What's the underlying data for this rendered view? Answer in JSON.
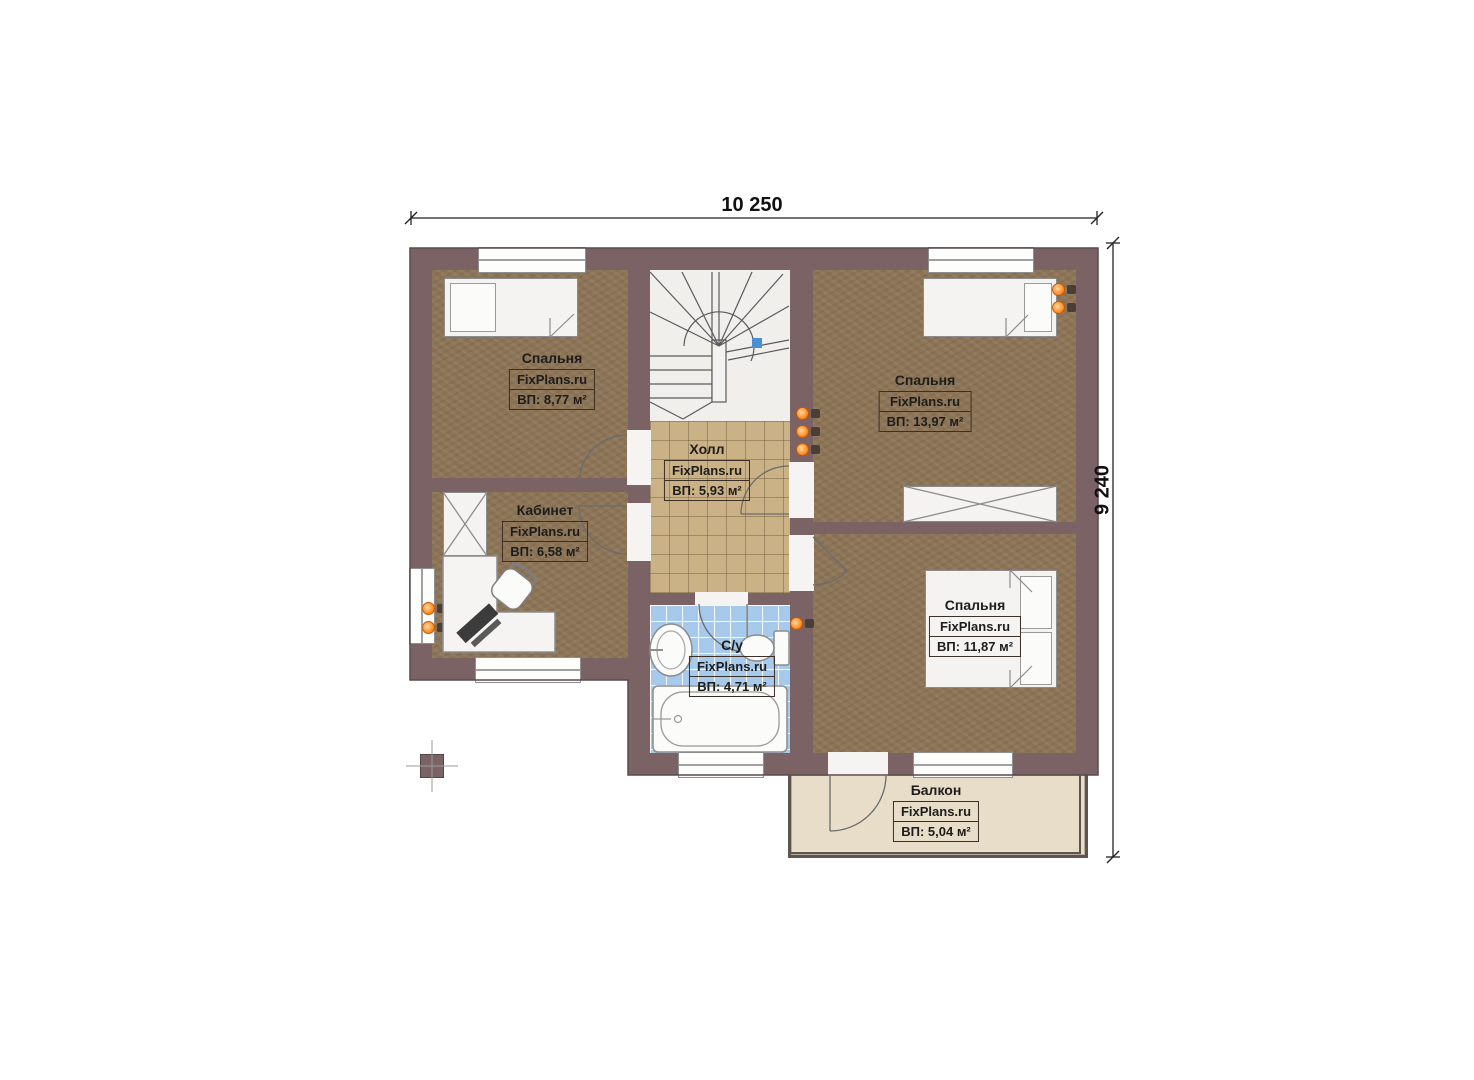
{
  "dimensions": {
    "width": "10 250",
    "height": "9 240"
  },
  "rooms": [
    {
      "name": "Спальня",
      "brand": "FixPlans.ru",
      "area": "ВП: 8,77 м²"
    },
    {
      "name": "Спальня",
      "brand": "FixPlans.ru",
      "area": "ВП: 13,97 м²"
    },
    {
      "name": "Кабинет",
      "brand": "FixPlans.ru",
      "area": "ВП: 6,58 м²"
    },
    {
      "name": "Холл",
      "brand": "FixPlans.ru",
      "area": "ВП: 5,93 м²"
    },
    {
      "name": "С/у",
      "brand": "FixPlans.ru",
      "area": "ВП: 4,71 м²"
    },
    {
      "name": "Спальня",
      "brand": "FixPlans.ru",
      "area": "ВП: 11,87 м²"
    },
    {
      "name": "Балкон",
      "brand": "FixPlans.ru",
      "area": "ВП: 5,04 м²"
    }
  ],
  "colors": {
    "wall": "#7b6265",
    "wood_floor": "#8c7456",
    "hall_tile": "#cbb286",
    "bath_tile": "#a6c9ec",
    "balcony_floor": "#e7ddc9",
    "stairs": "#f0efec",
    "radiator_orange": "#ff9433",
    "stair_marker_blue": "#4a8fd4"
  }
}
